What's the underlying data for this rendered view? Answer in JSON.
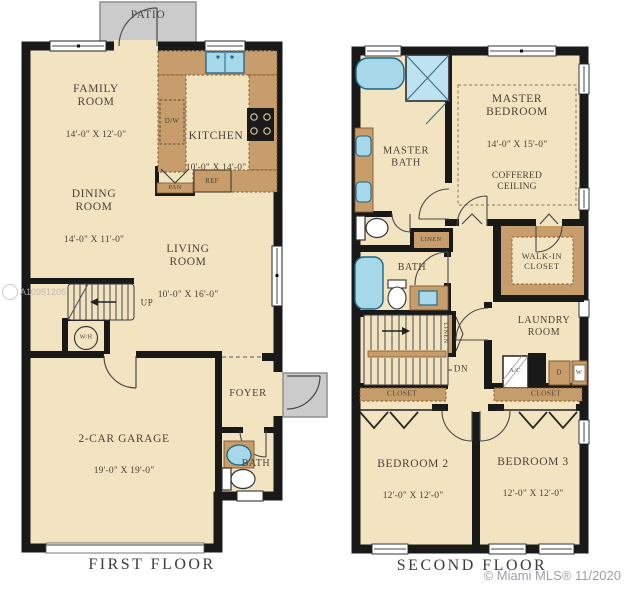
{
  "watermarks": {
    "listing_id": "A10951205",
    "credit": "© Miami MLS® 11/2020"
  },
  "colors": {
    "floor": "#F2E3C1",
    "wall": "#191919",
    "cabinet": "#C79E6B",
    "fixture_blue": "#A6D8EA",
    "patio_gray": "#CBCBCB"
  },
  "floor1": {
    "caption": "FIRST FLOOR",
    "patio": {
      "label": "PATIO"
    },
    "family_room": {
      "name": "FAMILY\nROOM",
      "dims": "14'-0\" X 12'-0\""
    },
    "kitchen": {
      "name": "KITCHEN",
      "dims": "10'-0\" X 14'-0\""
    },
    "dining_room": {
      "name": "DINING\nROOM",
      "dims": "14'-0\" X 11'-0\""
    },
    "living_room": {
      "name": "LIVING\nROOM",
      "dims": "10'-0\" X 16'-0\""
    },
    "garage": {
      "name": "2-CAR GARAGE",
      "dims": "19'-0\" X 19'-0\""
    },
    "foyer": {
      "name": "FOYER"
    },
    "bath": {
      "name": "BATH"
    },
    "fixtures": {
      "dishwasher": "D/W",
      "pantry": "PAN",
      "refrigerator": "REF",
      "stairs_up": "UP",
      "water_heater": "W/H"
    }
  },
  "floor2": {
    "caption": "SECOND FLOOR",
    "master_bath": {
      "name": "MASTER\nBATH"
    },
    "master_bedroom": {
      "name": "MASTER\nBEDROOM",
      "dims": "14'-0\" X 15'-0\"",
      "note": "COFFERED\nCEILING"
    },
    "bath": {
      "name": "BATH"
    },
    "walk_in_closet": {
      "name": "WALK-IN\nCLOSET"
    },
    "laundry_room": {
      "name": "LAUNDRY\nROOM"
    },
    "bedroom2": {
      "name": "BEDROOM 2",
      "dims": "12'-0\" X 12'-0\""
    },
    "bedroom3": {
      "name": "BEDROOM 3",
      "dims": "12'-0\" X 12'-0\""
    },
    "fixtures": {
      "linen_upper": "LINEN",
      "linen_lower": "LINEN",
      "stairs_down": "DN",
      "ac": "A/C",
      "dryer": "D",
      "washer": "W",
      "closet_b2": "CLOSET",
      "closet_b3": "CLOSET"
    }
  }
}
